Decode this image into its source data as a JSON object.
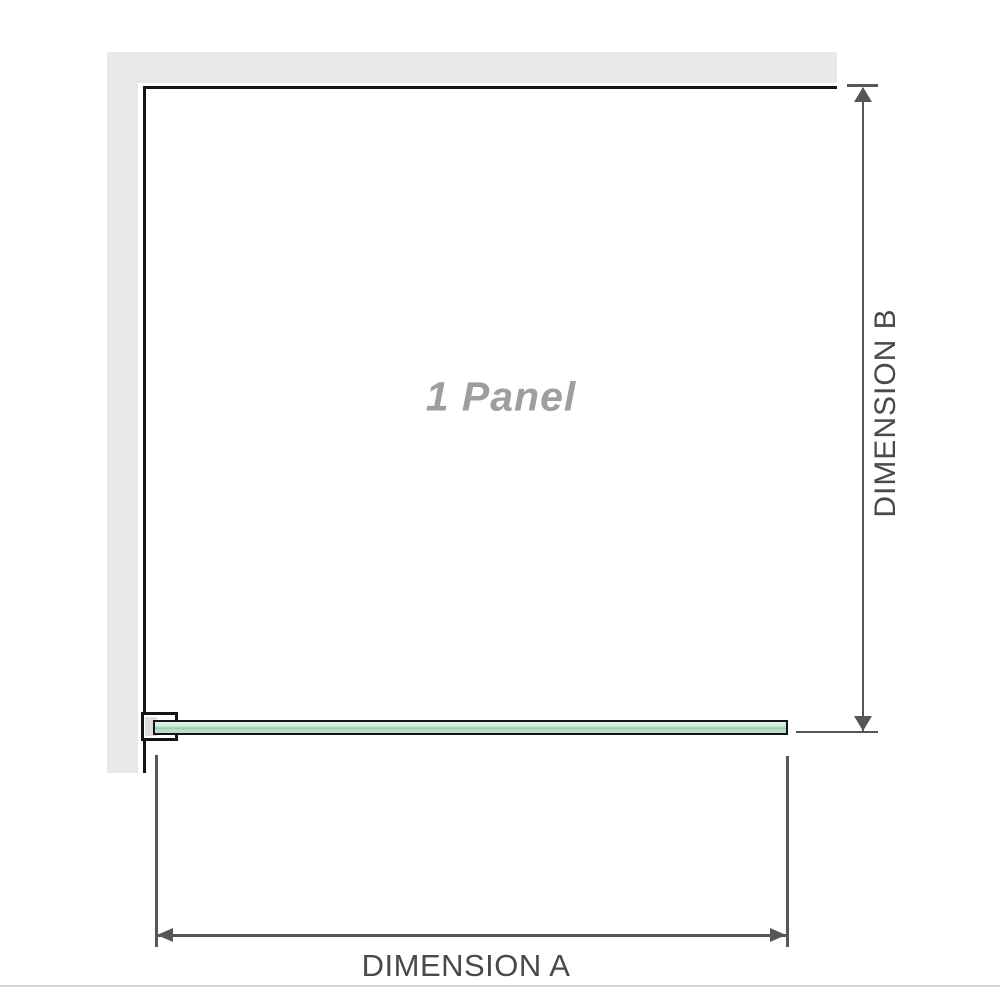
{
  "diagram": {
    "panel_label": "1 Panel",
    "dimension_a_label": "DIMENSION A",
    "dimension_b_label": "DIMENSION B"
  },
  "colors": {
    "background": "#ffffff",
    "wall_fill": "#e8e8e8",
    "wall_edge": "#141414",
    "glass_border": "#151515",
    "glass_light": "#e7f4ea",
    "glass_mid": "#c0e5cf",
    "glass_seam": "#8ac6a7",
    "bracket_fill": "#ffffff",
    "bracket_inner": "#dcdcdc",
    "dim_line": "#54565a",
    "dim_text": "#48494d",
    "panel_text": "#9d9ea0",
    "footer_line": "#d9d6d0"
  }
}
